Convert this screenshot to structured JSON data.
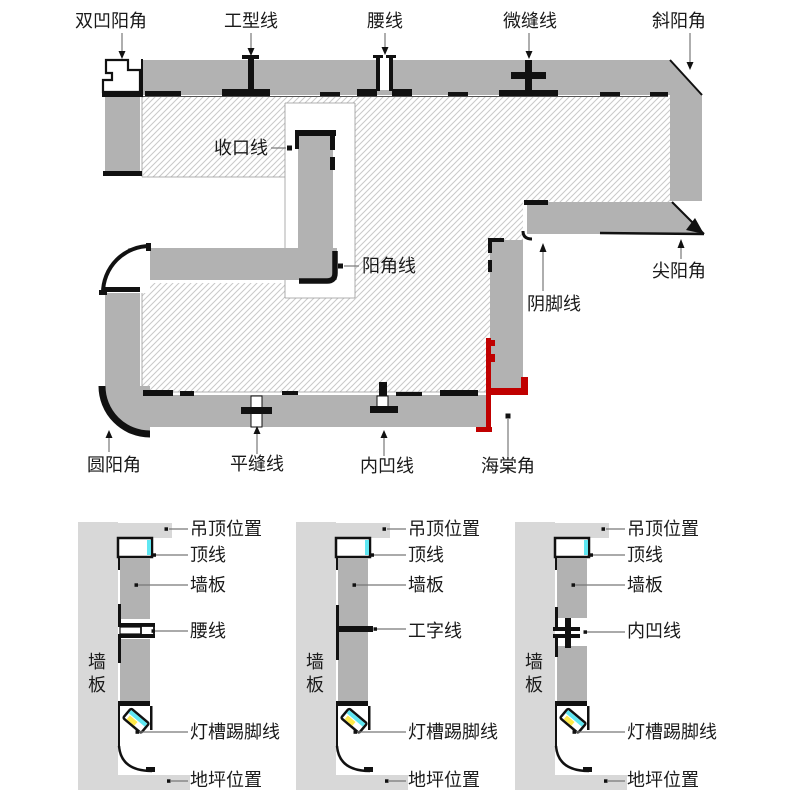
{
  "plan": {
    "labels": {
      "double_concave_corner": "双凹阳角",
      "i_type_line": "工型线",
      "waist_line": "腰线",
      "micro_seam_line": "微缝线",
      "bevel_corner": "斜阳角",
      "closing_line": "收口线",
      "outer_corner_line": "阳角线",
      "inner_foot_line": "阴脚线",
      "sharp_corner": "尖阳角",
      "round_corner": "圆阳角",
      "flat_seam_line": "平缝线",
      "concave_line": "内凹线",
      "begonia_corner": "海棠角"
    }
  },
  "sections": [
    {
      "side_wall_chars": [
        "墙",
        "板"
      ],
      "ceiling": "吊顶位置",
      "crown": "顶线",
      "panel": "墙板",
      "middle": "腰线",
      "skirting": "灯槽踢脚线",
      "floor": "地坪位置"
    },
    {
      "side_wall_chars": [
        "墙",
        "板"
      ],
      "ceiling": "吊顶位置",
      "crown": "顶线",
      "panel": "墙板",
      "middle": "工字线",
      "skirting": "灯槽踢脚线",
      "floor": "地坪位置"
    },
    {
      "side_wall_chars": [
        "墙",
        "板"
      ],
      "ceiling": "吊顶位置",
      "crown": "顶线",
      "panel": "墙板",
      "middle": "内凹线",
      "skirting": "灯槽踢脚线",
      "floor": "地坪位置"
    }
  ],
  "colors": {
    "accent_red": "#c00000",
    "panel_gray": "#b2b2b2",
    "light_gray": "#d8d8d8",
    "led_cyan": "#5fe7f2",
    "led_yellow": "#ffe94a"
  }
}
